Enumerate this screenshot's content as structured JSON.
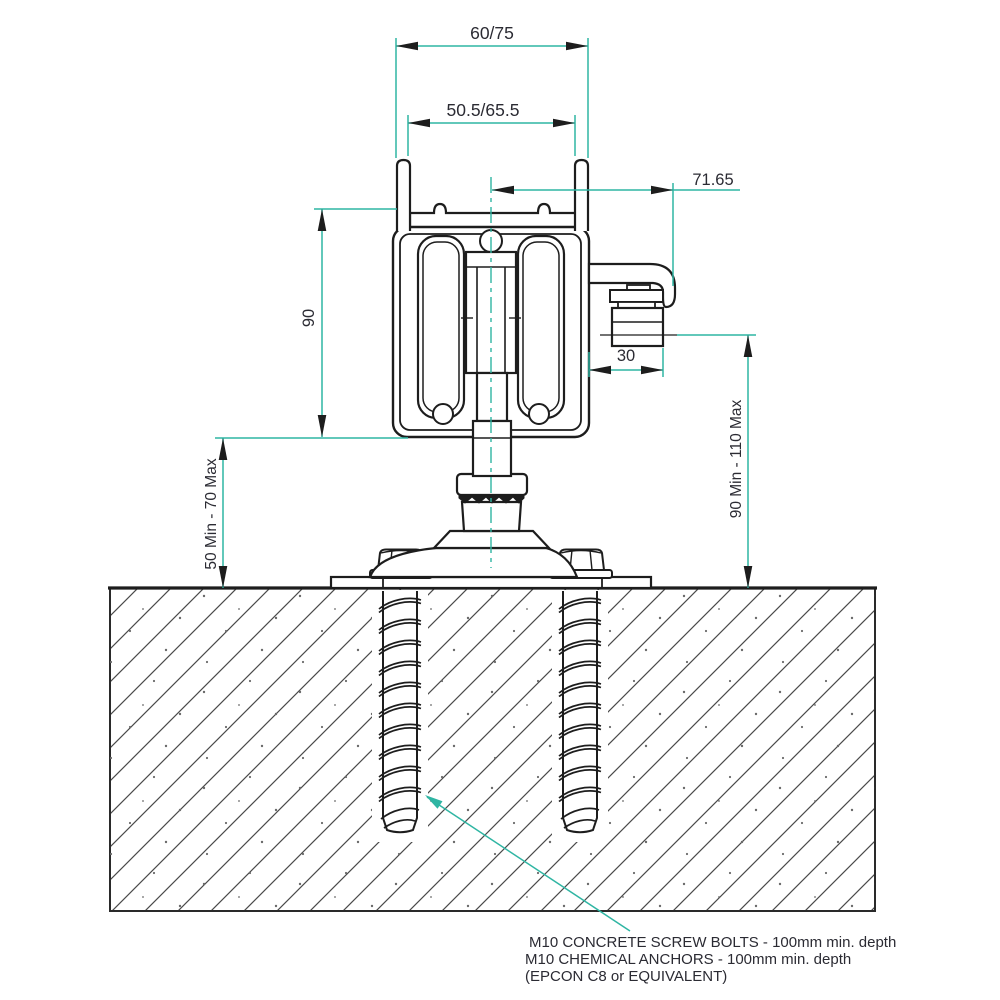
{
  "drawing": {
    "title": "Sliding gate track and concrete fixing cross-section",
    "colors": {
      "line": "#1d1d1d",
      "dimension_line": "#2fb5a3",
      "text": "#2b2b33",
      "background": "#ffffff"
    },
    "dimensions": {
      "top_outer_width": "60/75",
      "top_inner_width": "50.5/65.5",
      "bracket_offset": "71.65",
      "track_height": "90",
      "roller_offset": "30",
      "left_clearance": "50 Min - 70 Max",
      "right_clearance": "90 Min - 110 Max"
    },
    "annotation": {
      "line1": "M10 CONCRETE SCREW BOLTS - 100mm min. depth",
      "line2": "M10 CHEMICAL ANCHORS - 100mm min. depth",
      "line3": "(EPCON C8 or EQUIVALENT)"
    }
  }
}
